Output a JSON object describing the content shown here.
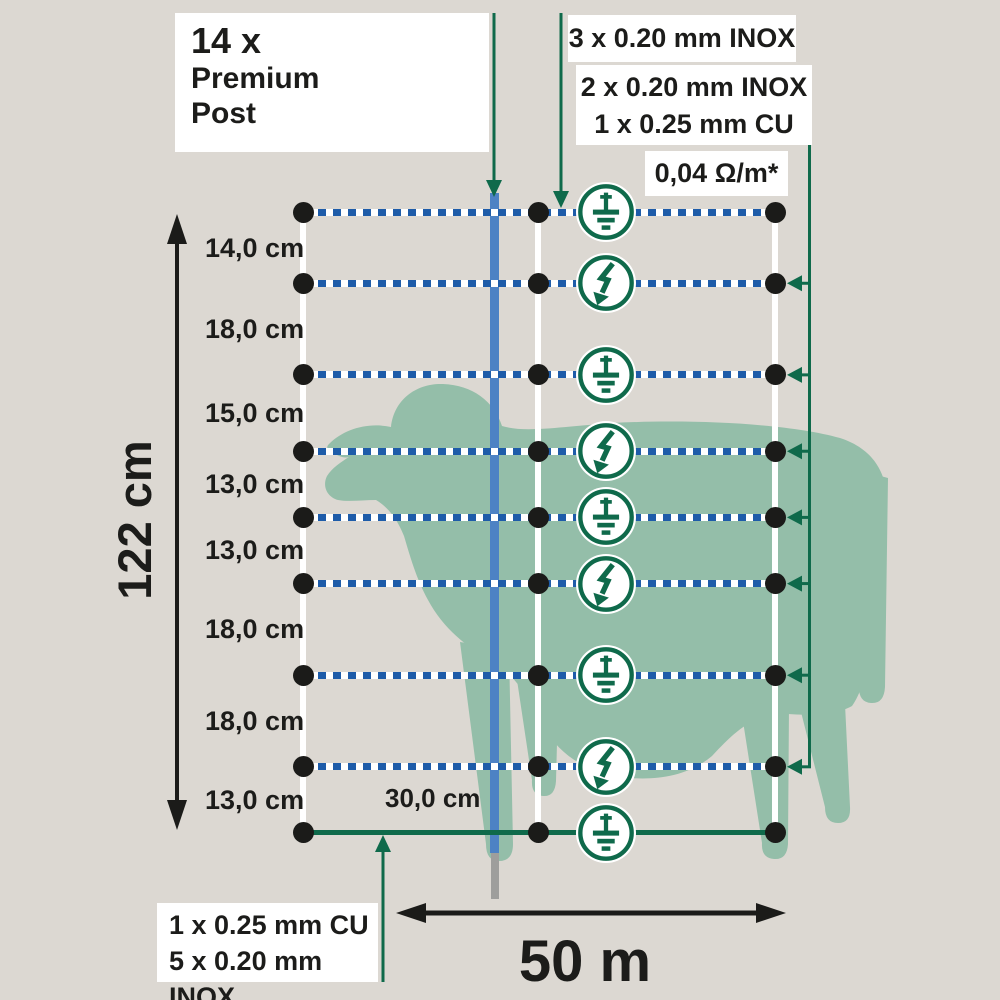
{
  "title_box": {
    "count": "14 x",
    "product_line1": "Premium",
    "product_line2": "Post"
  },
  "specs": {
    "top_wire": "3 x 0.20 mm INOX",
    "live_wires_line1": "2 x 0.20 mm INOX",
    "live_wires_line2": "1 x 0.25 mm CU",
    "resistance": "0,04 Ω/m*",
    "bottom_wire_line1": "1 x 0.25 mm CU",
    "bottom_wire_line2": "5 x 0.20 mm INOX"
  },
  "measurements": {
    "net_height": "122 cm",
    "net_length": "50 m",
    "strut_spacing": "30,0 cm",
    "wire_spacings": [
      "14,0 cm",
      "18,0 cm",
      "15,0 cm",
      "13,0 cm",
      "13,0 cm",
      "18,0 cm",
      "18,0 cm",
      "13,0 cm"
    ]
  },
  "net": {
    "spacings_cm": [
      14,
      18,
      15,
      13,
      13,
      18,
      18,
      13
    ],
    "wires": [
      {
        "position": 1,
        "icon": "earth-icon",
        "type": "ground"
      },
      {
        "position": 2,
        "icon": "lightning-icon",
        "type": "live"
      },
      {
        "position": 3,
        "icon": "earth-icon",
        "type": "ground"
      },
      {
        "position": 4,
        "icon": "lightning-icon",
        "type": "live"
      },
      {
        "position": 5,
        "icon": "earth-icon",
        "type": "ground"
      },
      {
        "position": 6,
        "icon": "lightning-icon",
        "type": "live"
      },
      {
        "position": 7,
        "icon": "earth-icon",
        "type": "ground"
      },
      {
        "position": 8,
        "icon": "lightning-icon",
        "type": "live"
      },
      {
        "position": 9,
        "icon": "earth-icon",
        "type": "ground"
      }
    ],
    "live_connected_positions": [
      2,
      3,
      4,
      5,
      6,
      7,
      8
    ]
  },
  "colors": {
    "background": "#dcd8d2",
    "sheep": "#94bea9",
    "green": "#0f6a4b",
    "wire_blue": "#1e5ca9",
    "post_blue": "#4d82c4",
    "post_tip_gray": "#9e9e9c",
    "text": "#1c1c1a",
    "box_bg": "#ffffff"
  }
}
